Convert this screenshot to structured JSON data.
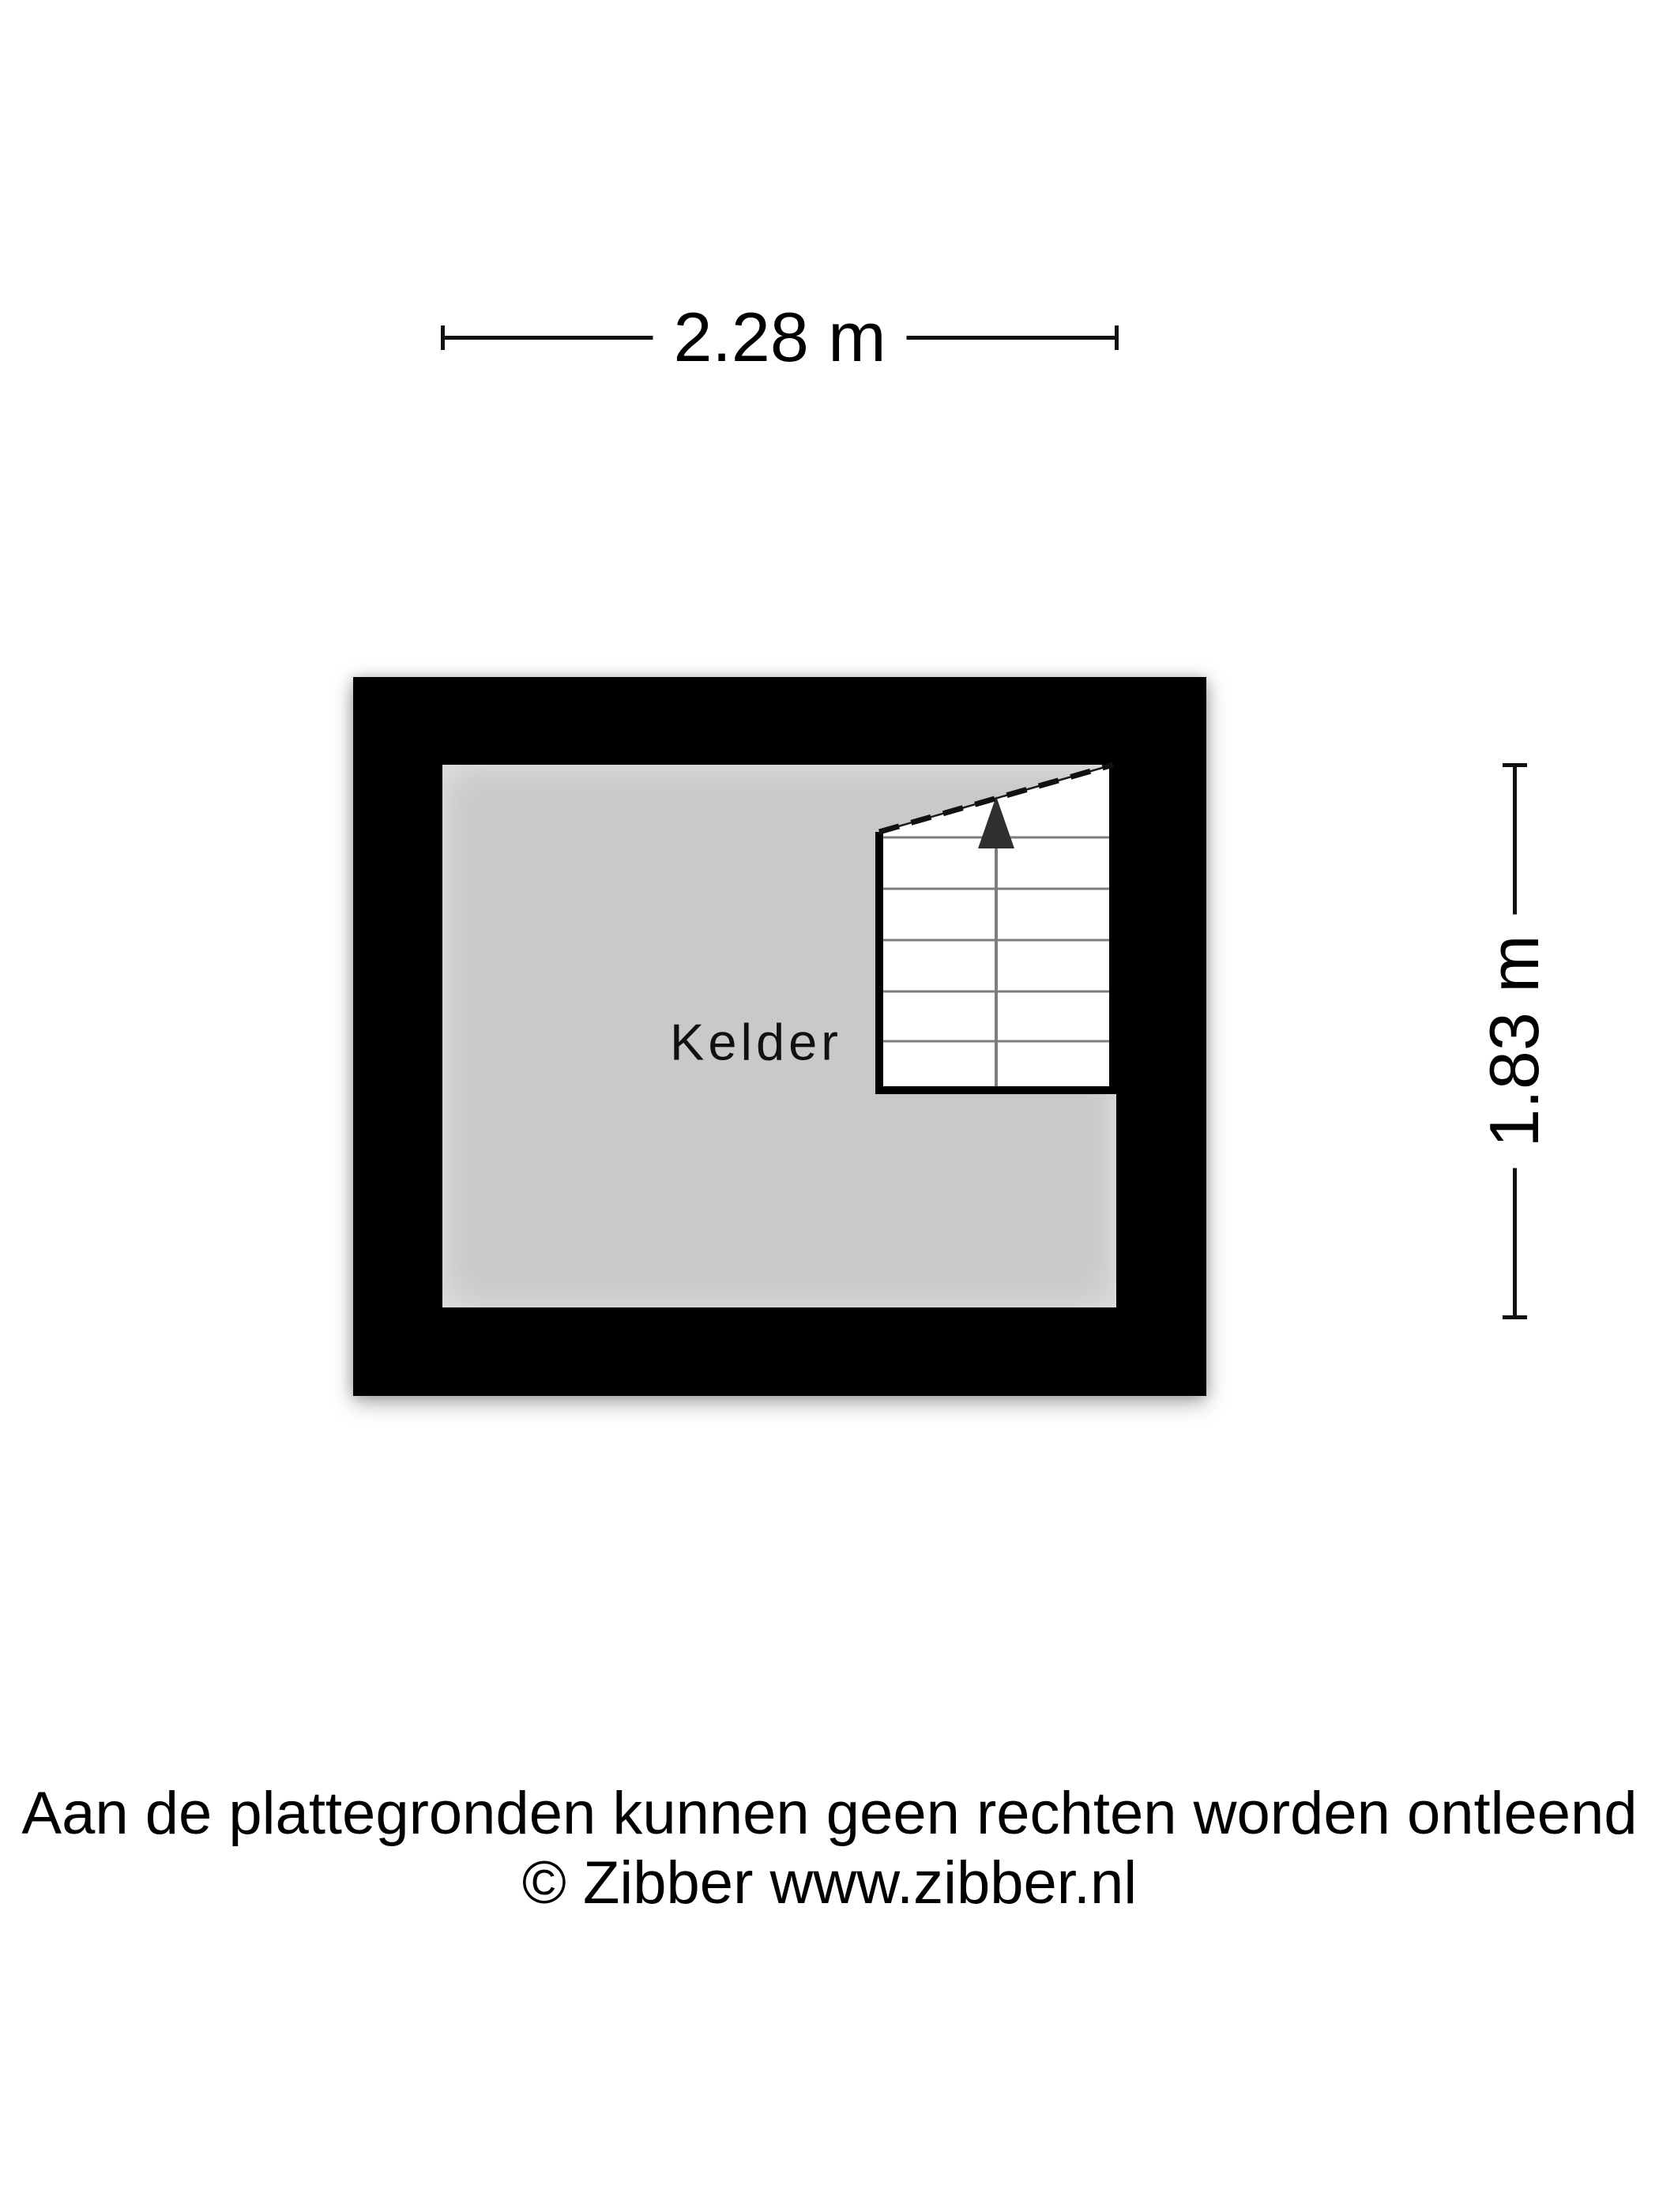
{
  "page": {
    "background_color": "#ffffff",
    "title": "Kelder plattegrond"
  },
  "dimensions": {
    "width_label": "2.28 m",
    "height_label": "1.83 m"
  },
  "floorplan": {
    "room_label": "Kelder",
    "wall_color": "#000000",
    "floor_color": "#c9c9c9",
    "stair": {
      "step_lines": 5,
      "direction": "up",
      "arrow_color": "#2f2f2f",
      "step_line_color": "#7d7d7d"
    }
  },
  "footer": {
    "line1": "Aan de plattegronden kunnen geen rechten worden ontleend",
    "line2": "© Zibber www.zibber.nl"
  }
}
